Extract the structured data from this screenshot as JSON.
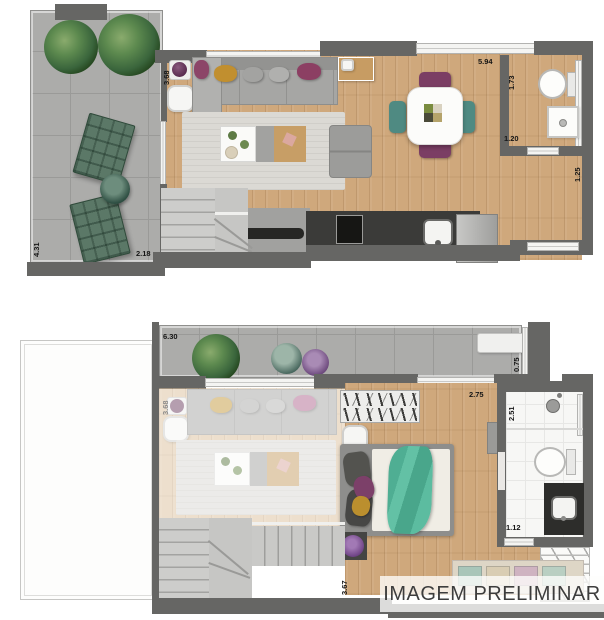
{
  "banner": {
    "text": "IMAGEM PRELIMINAR"
  },
  "floor1": {
    "dims": {
      "living_depth": "3.68",
      "living_width": "5.94",
      "lavabo_depth": "1.73",
      "lavabo_width": "1.20",
      "entry_side": "1.25",
      "terrace_depth": "4.31",
      "terrace_width": "2.18"
    }
  },
  "floor2": {
    "dims": {
      "balcony_width": "6.30",
      "balcony_depth": "0.75",
      "bedroom_width": "2.75",
      "bathroom_depth": "2.51",
      "bathroom_width": "1.12",
      "bedroom_depth": "3.67",
      "void_living_depth": "3.68"
    }
  }
}
